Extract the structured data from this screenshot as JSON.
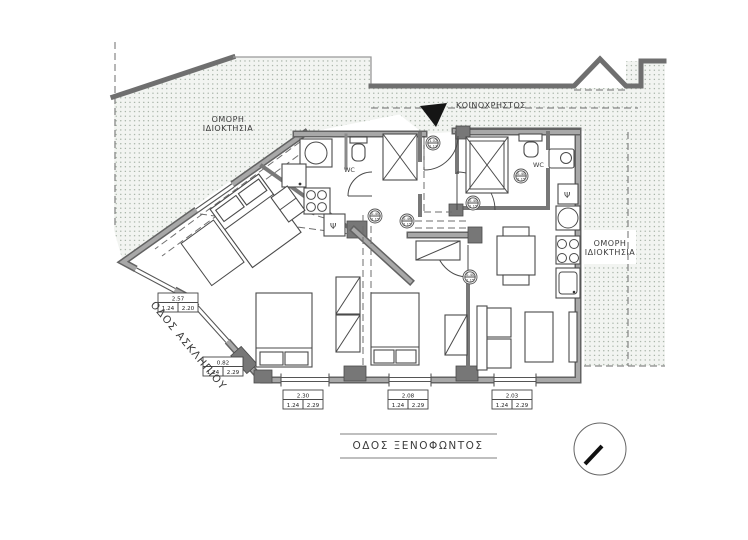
{
  "plan": {
    "type": "architectural floor plan",
    "streets": {
      "left": "ΟΔΟΣ ΑΣΚΛΗΠΙΟΥ",
      "bottom": "ΟΔΟΣ ΞΕΝΟΦΩΝΤΟΣ"
    },
    "labels": {
      "communal": "ΚΟΙΝΟΧΡΗΣΤΟΣ",
      "neighbor_line1": "ΟΜΟΡΗ",
      "neighbor_line2": "ΙΔΙΟΚΤΗΣΙΑ",
      "wc": "WC",
      "fridge": "Ψ"
    },
    "dimensions": [
      {
        "width": "2.57",
        "a": "1.24",
        "b": "2.20"
      },
      {
        "width": "0.82",
        "a": "1.24",
        "b": "2.29"
      },
      {
        "width": "2.30",
        "a": "1.24",
        "b": "2.29"
      },
      {
        "width": "2.08",
        "a": "1.24",
        "b": "2.29"
      },
      {
        "width": "2.03",
        "a": "1.24",
        "b": "2.29"
      }
    ],
    "level_markers": [
      {
        "top": "0.40",
        "bottom": "2.15"
      },
      {
        "top": "0.46",
        "bottom": "2.15"
      },
      {
        "top": "0.40",
        "bottom": "2.15"
      },
      {
        "top": "0.40",
        "bottom": "2.15"
      },
      {
        "top": "0.40",
        "bottom": "2.15"
      },
      {
        "top": "1.02",
        "bottom": "2.13"
      }
    ],
    "colors": {
      "wall_gray": "#a8a8a8",
      "wall_edge": "#636363",
      "stipple_dot": "#93a193",
      "stipple_bg": "#f2f4f1",
      "arrow_black": "#151515"
    }
  }
}
